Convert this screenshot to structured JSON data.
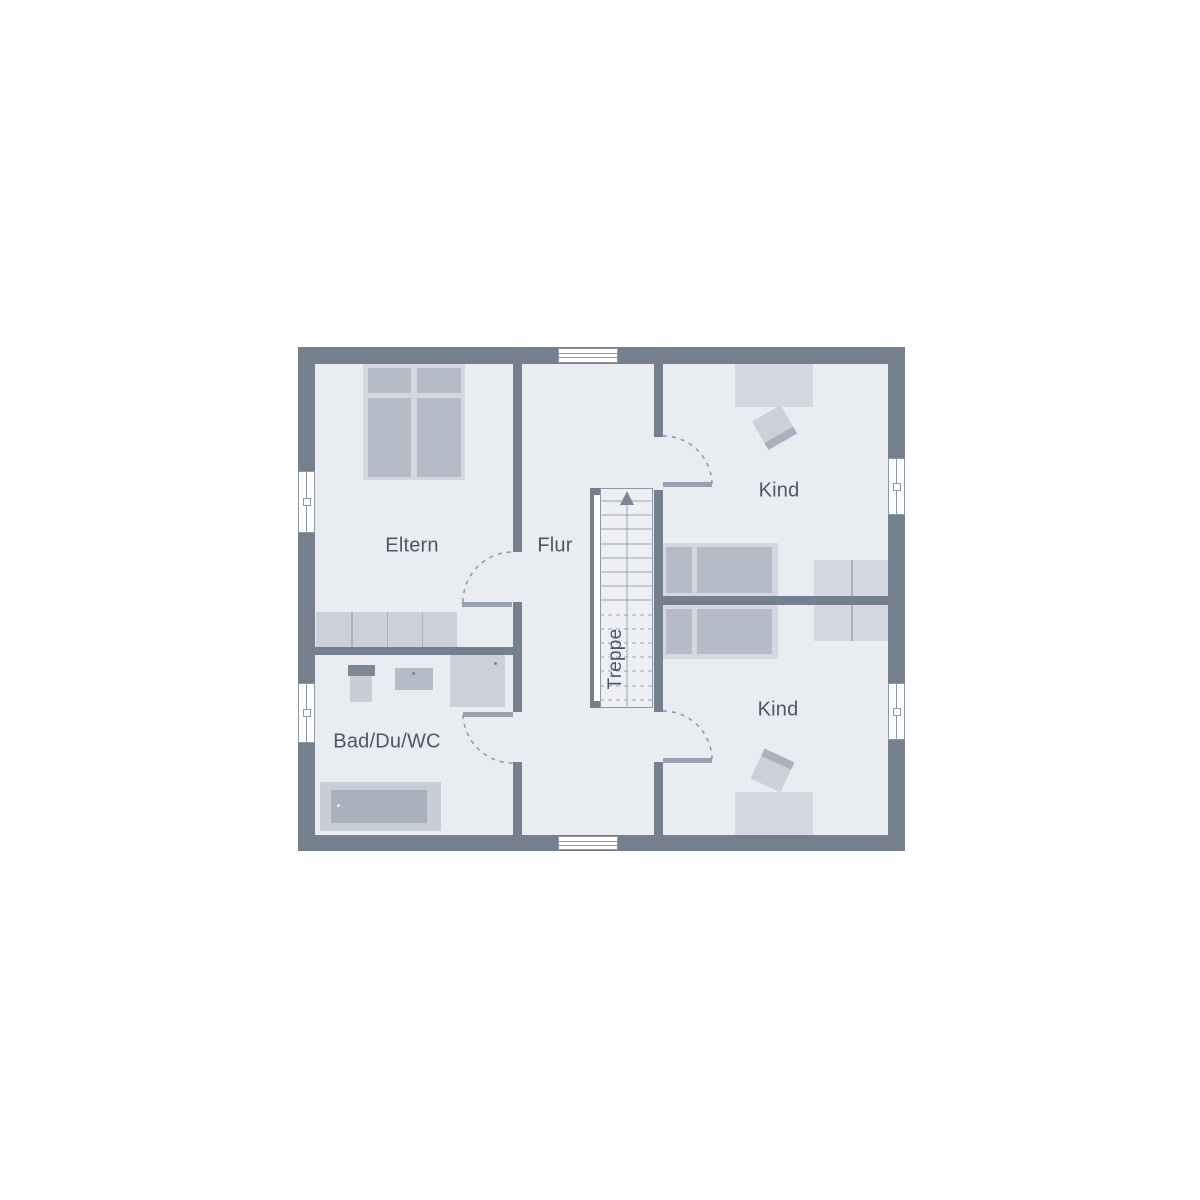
{
  "plan": {
    "type": "floor-plan-upper-storey",
    "rooms": {
      "eltern": "Eltern",
      "flur": "Flur",
      "kind_top": "Kind",
      "kind_bottom": "Kind",
      "bad": "Bad/Du/WC",
      "stairs": "Treppe"
    }
  },
  "colors": {
    "outside": "#FFFFFF",
    "wall": "#75808F",
    "floor": "#E9ECF1",
    "stair_floor": "#EDEFF4",
    "line": "#8E97A4",
    "tread": "#9AA3B0",
    "arc": "#8E98A6",
    "sill": "#98A1AE",
    "text": "#4D5766",
    "furn_light": "#D5D8E0",
    "furn_mid": "#B5BCC8",
    "furn_soft": "#CCD0D9",
    "fixture": "#C9CDD6",
    "fixture_dark": "#A9B0BE",
    "dark_accent": "#7E8897",
    "white": "#FFFFFF"
  }
}
